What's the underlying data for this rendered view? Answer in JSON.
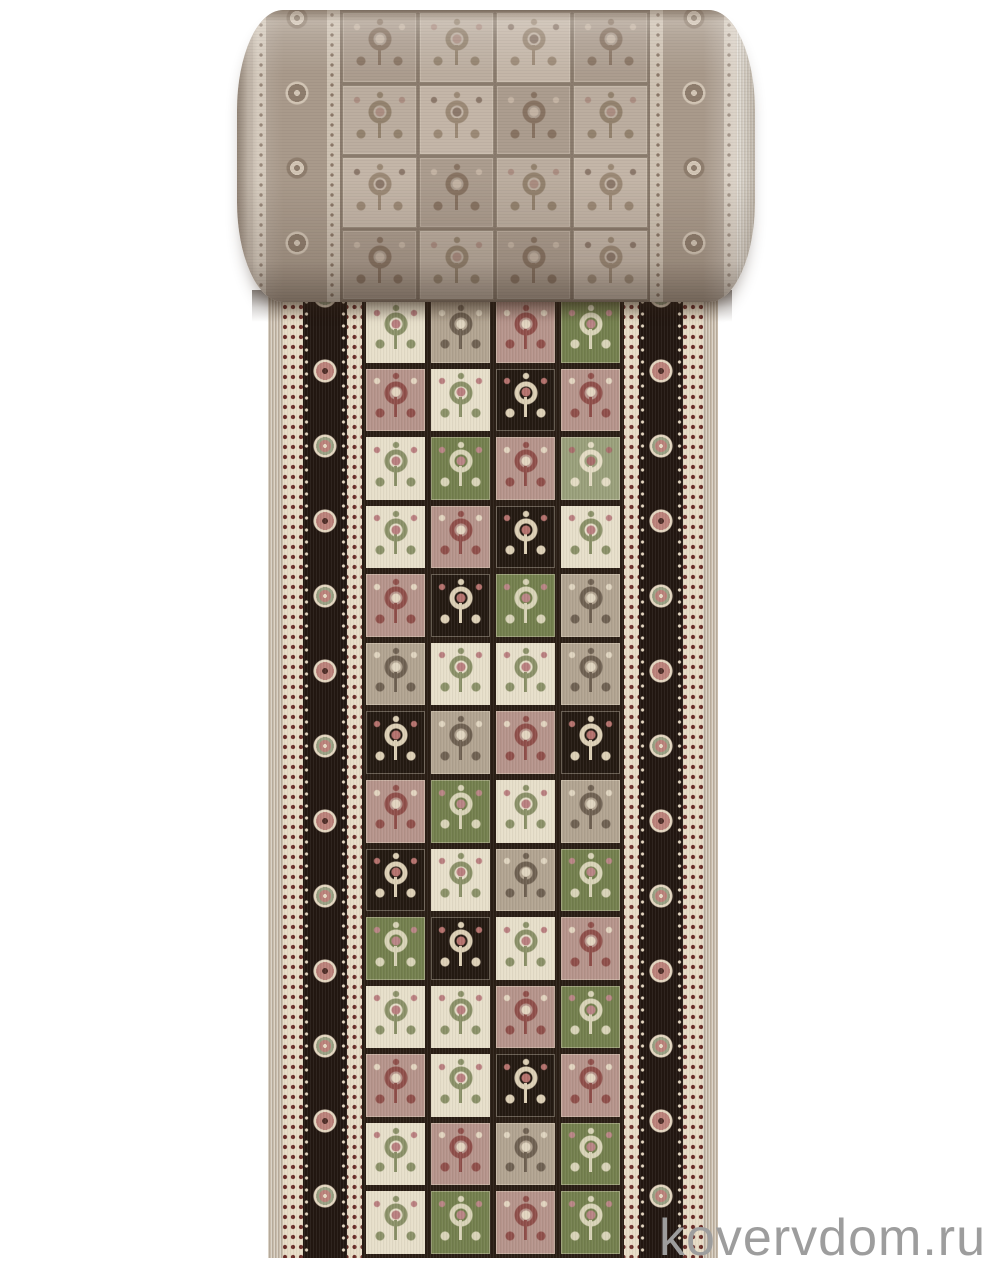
{
  "image": {
    "kind": "product-photo",
    "subject": "beige carpet runner, partly rolled at top, flat strip below, Bakhtiari-style panel (garden tile) pattern",
    "background_color": "#ffffff"
  },
  "watermark": {
    "text": "kovervdom.ru",
    "color": "#9d9d9d"
  },
  "palette": {
    "white": "#ffffff",
    "grid": "#2a1e15",
    "selvage": "#c9bcab",
    "selvage_light": "#d6cec1",
    "guard_bg": "#e8dcc6",
    "guard_dot": "#6a2d28",
    "band_bg": "#221711",
    "rosette_pink": "#bb827a",
    "rosette_cream": "#e5d7c1",
    "rosette_green": "#9aa184",
    "rosette_core": "#51302a",
    "roll_band": "#a99a8b",
    "roll_guard": "#cfc3b4",
    "roll_dot": "#8b7868",
    "roll_rosette": "#8f7e6e",
    "roll_rosette_light": "#d3c6b6",
    "roll_grid": "#8a7b6d",
    "watermark": "#9d9d9d"
  },
  "colorways": {
    "cream": {
      "bg": "#e7dfca",
      "motif": "#8b9168",
      "accent": "#b97f7f"
    },
    "rose": {
      "bg": "#b6948b",
      "motif": "#8f4f4a",
      "accent": "#e3d5c0"
    },
    "taupe": {
      "bg": "#b2a491",
      "motif": "#6f6152",
      "accent": "#e0d5c0"
    },
    "green": {
      "bg": "#74804e",
      "motif": "#d9d4b8",
      "accent": "#b98585"
    },
    "sage": {
      "bg": "#9aa07b",
      "motif": "#e4dcc4",
      "accent": "#a76e6a"
    },
    "black": {
      "bg": "#241a12",
      "motif": "#ddd0b6",
      "accent": "#b5726d"
    },
    "rm1": {
      "bg": "#bcaea0",
      "motif": "#94836f",
      "accent": "#ab8e82"
    },
    "rm2": {
      "bg": "#ac9d8f",
      "motif": "#887463",
      "accent": "#c4b4a4"
    },
    "rm3": {
      "bg": "#c4b6a8",
      "motif": "#9c8a77",
      "accent": "#8d7a6c"
    }
  },
  "flat_rows": [
    [
      "cream",
      "taupe",
      "rose",
      "green"
    ],
    [
      "rose",
      "cream",
      "black",
      "rose"
    ],
    [
      "cream",
      "green",
      "rose",
      "sage"
    ],
    [
      "cream",
      "rose",
      "black",
      "cream"
    ],
    [
      "rose",
      "black",
      "green",
      "taupe"
    ],
    [
      "taupe",
      "cream",
      "cream",
      "taupe"
    ],
    [
      "black",
      "taupe",
      "rose",
      "black"
    ],
    [
      "rose",
      "green",
      "cream",
      "taupe"
    ],
    [
      "black",
      "cream",
      "taupe",
      "green"
    ],
    [
      "green",
      "black",
      "cream",
      "rose"
    ],
    [
      "cream",
      "cream",
      "rose",
      "green"
    ],
    [
      "rose",
      "cream",
      "black",
      "rose"
    ],
    [
      "cream",
      "rose",
      "taupe",
      "green"
    ],
    [
      "cream",
      "green",
      "rose",
      "green"
    ]
  ],
  "roll_rows": [
    [
      "rm2",
      "rm1",
      "rm3",
      "rm2"
    ],
    [
      "rm1",
      "rm3",
      "rm2",
      "rm1"
    ],
    [
      "rm3",
      "rm2",
      "rm1",
      "rm3"
    ],
    [
      "rm2",
      "rm1",
      "rm2",
      "rm3"
    ]
  ]
}
